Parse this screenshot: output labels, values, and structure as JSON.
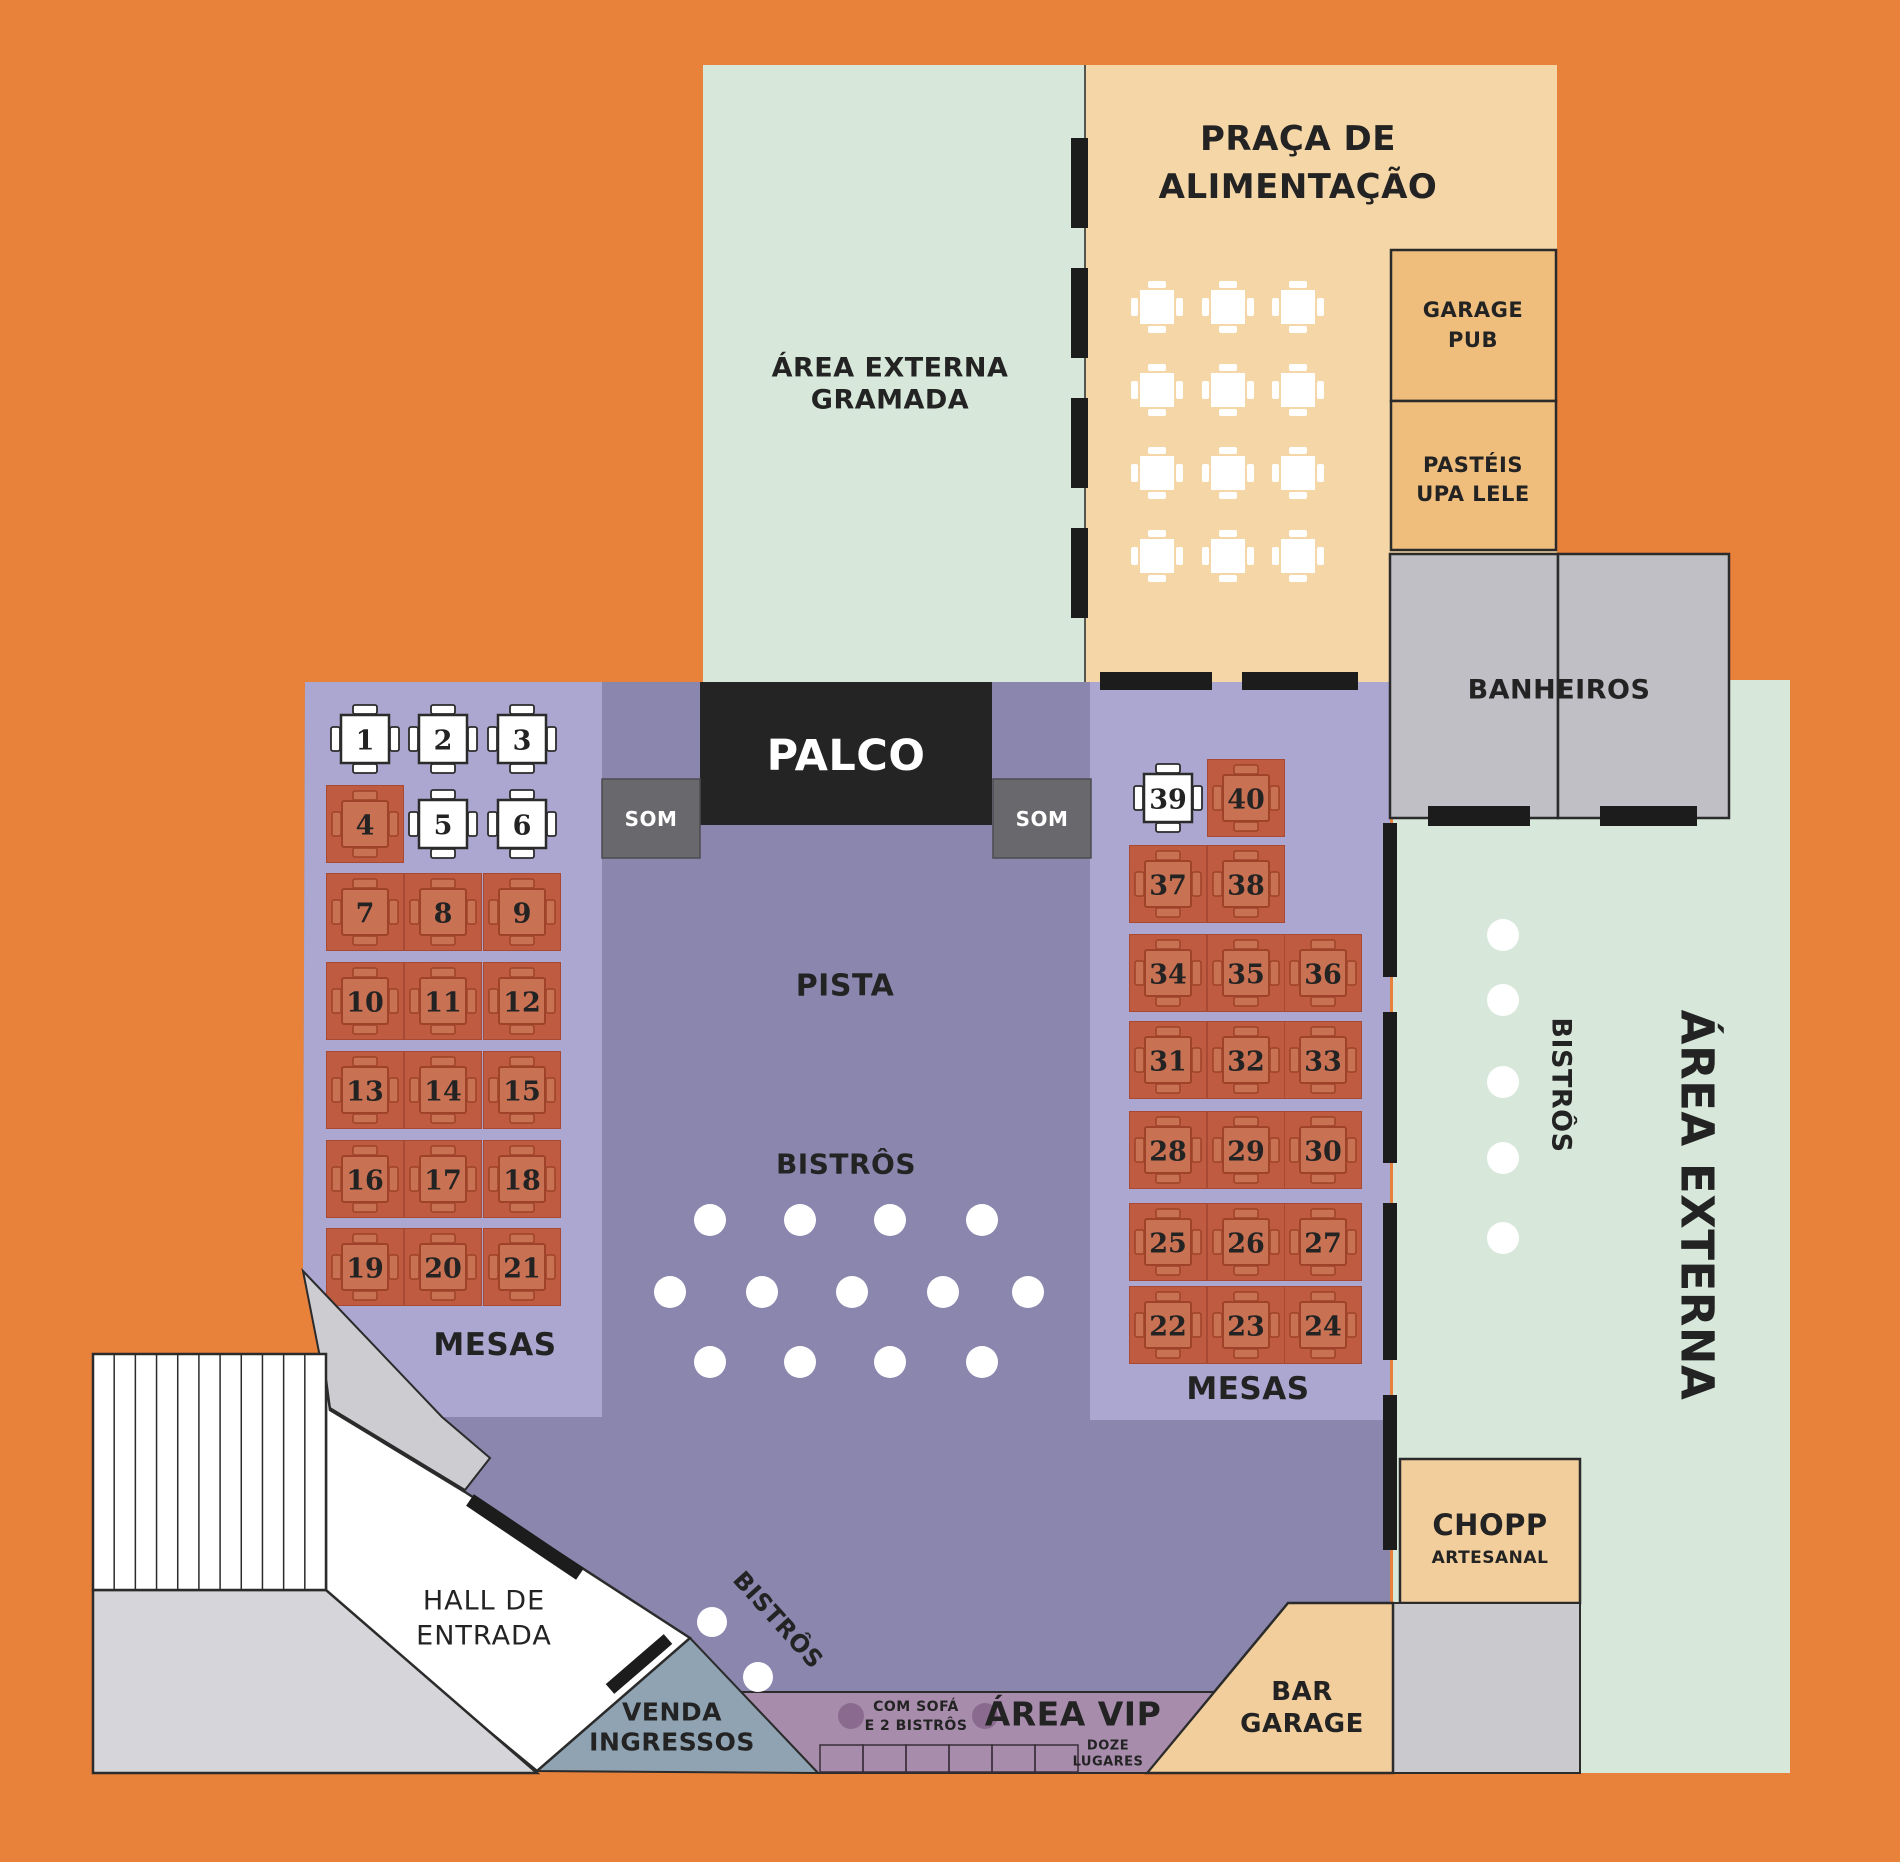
{
  "palette": {
    "background": "#E8813A",
    "grass_green": "#D7E8DA",
    "food_court_tan": "#F5D6A7",
    "shop_tan": "#EFBE7D",
    "warm_tan": "#F2CE9C",
    "restroom_gray": "#C0BFC5",
    "hall_purple": "#8A86AE",
    "panel_purple": "#ABA7D0",
    "stage_black": "#242424",
    "sound_gray": "#68686D",
    "vip_mauve": "#A78CAC",
    "vip_dot": "#8A6B8F",
    "ticket_blue_gray": "#8FA3B2",
    "band_gray": "#CDCDD1",
    "lower_gray": "#D6D6DA",
    "wall_black": "#1C1C1C",
    "table_free_fill": "#FFFFFF",
    "table_occupied_bg": "#BE5B40",
    "table_occupied_top": "#C97153",
    "table_occupied_line": "#9E4229",
    "table_occupied_num": "#8E3B24",
    "outline_dark": "#2B2B2B"
  },
  "areas": {
    "gramada": {
      "line1": "ÁREA EXTERNA",
      "line2": "GRAMADA"
    },
    "praca": {
      "line1": "PRAÇA DE",
      "line2": "ALIMENTAÇÃO"
    },
    "garage_pub": {
      "line1": "GARAGE",
      "line2": "PUB"
    },
    "pasteis": {
      "line1": "PASTÉIS",
      "line2": "UPA LELE"
    },
    "banheiros": {
      "label": "BANHEIROS"
    },
    "area_externa": {
      "label": "ÁREA EXTERNA"
    },
    "bistros_lateral": {
      "label": "BISTRÔS"
    },
    "chopp": {
      "line1": "CHOPP",
      "line2": "ARTESANAL"
    },
    "bar_garage": {
      "line1": "BAR",
      "line2": "GARAGE"
    },
    "palco": {
      "label": "PALCO"
    },
    "som_left": {
      "label": "SOM"
    },
    "som_right": {
      "label": "SOM"
    },
    "pista": {
      "label": "PISTA"
    },
    "bistros_pista": {
      "label": "BISTRÔS"
    },
    "mesas_left": {
      "label": "MESAS"
    },
    "mesas_right": {
      "label": "MESAS"
    },
    "hall": {
      "line1": "HALL DE",
      "line2": "ENTRADA"
    },
    "venda": {
      "line1": "VENDA",
      "line2": "INGRESSOS"
    },
    "vip": {
      "label": "ÁREA VIP",
      "sofa_line1": "COM SOFÁ",
      "sofa_line2": "E 2 BISTRÔS",
      "cap_line1": "DOZE",
      "cap_line2": "LUGARES"
    },
    "bistros_entrada": {
      "label": "BISTRÔS"
    }
  },
  "tables": {
    "left": [
      {
        "n": "1",
        "x": 365,
        "y": 739,
        "free": true
      },
      {
        "n": "2",
        "x": 443,
        "y": 739,
        "free": true
      },
      {
        "n": "3",
        "x": 522,
        "y": 739,
        "free": true
      },
      {
        "n": "4",
        "x": 365,
        "y": 824,
        "free": false
      },
      {
        "n": "5",
        "x": 443,
        "y": 824,
        "free": true
      },
      {
        "n": "6",
        "x": 522,
        "y": 824,
        "free": true
      },
      {
        "n": "7",
        "x": 365,
        "y": 912,
        "free": false
      },
      {
        "n": "8",
        "x": 443,
        "y": 912,
        "free": false
      },
      {
        "n": "9",
        "x": 522,
        "y": 912,
        "free": false
      },
      {
        "n": "10",
        "x": 365,
        "y": 1001,
        "free": false
      },
      {
        "n": "11",
        "x": 443,
        "y": 1001,
        "free": false
      },
      {
        "n": "12",
        "x": 522,
        "y": 1001,
        "free": false
      },
      {
        "n": "13",
        "x": 365,
        "y": 1090,
        "free": false
      },
      {
        "n": "14",
        "x": 443,
        "y": 1090,
        "free": false
      },
      {
        "n": "15",
        "x": 522,
        "y": 1090,
        "free": false
      },
      {
        "n": "16",
        "x": 365,
        "y": 1179,
        "free": false
      },
      {
        "n": "17",
        "x": 443,
        "y": 1179,
        "free": false
      },
      {
        "n": "18",
        "x": 522,
        "y": 1179,
        "free": false
      },
      {
        "n": "19",
        "x": 365,
        "y": 1267,
        "free": false
      },
      {
        "n": "20",
        "x": 443,
        "y": 1267,
        "free": false
      },
      {
        "n": "21",
        "x": 522,
        "y": 1267,
        "free": false
      }
    ],
    "right": [
      {
        "n": "39",
        "x": 1168,
        "y": 798,
        "free": true
      },
      {
        "n": "40",
        "x": 1246,
        "y": 798,
        "free": false
      },
      {
        "n": "37",
        "x": 1168,
        "y": 884,
        "free": false
      },
      {
        "n": "38",
        "x": 1246,
        "y": 884,
        "free": false
      },
      {
        "n": "34",
        "x": 1168,
        "y": 973,
        "free": false
      },
      {
        "n": "35",
        "x": 1246,
        "y": 973,
        "free": false
      },
      {
        "n": "36",
        "x": 1323,
        "y": 973,
        "free": false
      },
      {
        "n": "31",
        "x": 1168,
        "y": 1060,
        "free": false
      },
      {
        "n": "32",
        "x": 1246,
        "y": 1060,
        "free": false
      },
      {
        "n": "33",
        "x": 1323,
        "y": 1060,
        "free": false
      },
      {
        "n": "28",
        "x": 1168,
        "y": 1150,
        "free": false
      },
      {
        "n": "29",
        "x": 1246,
        "y": 1150,
        "free": false
      },
      {
        "n": "30",
        "x": 1323,
        "y": 1150,
        "free": false
      },
      {
        "n": "25",
        "x": 1168,
        "y": 1242,
        "free": false
      },
      {
        "n": "26",
        "x": 1246,
        "y": 1242,
        "free": false
      },
      {
        "n": "27",
        "x": 1323,
        "y": 1242,
        "free": false
      },
      {
        "n": "22",
        "x": 1168,
        "y": 1325,
        "free": false
      },
      {
        "n": "23",
        "x": 1246,
        "y": 1325,
        "free": false
      },
      {
        "n": "24",
        "x": 1323,
        "y": 1325,
        "free": false
      }
    ]
  },
  "food_court_tables": {
    "xs": [
      1157,
      1228,
      1298
    ],
    "ys": [
      307,
      390,
      473,
      556
    ]
  },
  "bistro_dots": {
    "pista": [
      [
        710,
        1220
      ],
      [
        800,
        1220
      ],
      [
        890,
        1220
      ],
      [
        982,
        1220
      ],
      [
        670,
        1292
      ],
      [
        762,
        1292
      ],
      [
        852,
        1292
      ],
      [
        943,
        1292
      ],
      [
        1028,
        1292
      ],
      [
        710,
        1362
      ],
      [
        800,
        1362
      ],
      [
        890,
        1362
      ],
      [
        982,
        1362
      ]
    ],
    "lateral": [
      [
        1503,
        935
      ],
      [
        1503,
        1000
      ],
      [
        1503,
        1082
      ],
      [
        1503,
        1158
      ],
      [
        1503,
        1238
      ]
    ],
    "entrada": [
      [
        712,
        1622
      ],
      [
        758,
        1677
      ]
    ]
  },
  "vip": {
    "dots": [
      [
        851,
        1716
      ],
      [
        985,
        1716
      ]
    ],
    "sofa_seats": {
      "x": 820,
      "y": 1745,
      "w": 258,
      "h": 27,
      "count": 6
    }
  },
  "walls": {
    "food_court_left": {
      "x": 1071,
      "w": 17,
      "segments": [
        [
          138,
          90
        ],
        [
          268,
          90
        ],
        [
          398,
          90
        ],
        [
          528,
          90
        ]
      ]
    },
    "panel_top": {
      "y": 672,
      "h": 18,
      "segments": [
        [
          1100,
          112
        ],
        [
          1242,
          116
        ]
      ]
    },
    "panel_right": {
      "x": 1383,
      "w": 14,
      "segments": [
        [
          823,
          154
        ],
        [
          1012,
          151
        ],
        [
          1203,
          157
        ],
        [
          1395,
          155
        ]
      ]
    },
    "restroom_doors": {
      "y": 806,
      "h": 20,
      "segments": [
        [
          1428,
          102
        ],
        [
          1600,
          97
        ]
      ]
    }
  },
  "stairs": {
    "stripe_count": 10
  }
}
